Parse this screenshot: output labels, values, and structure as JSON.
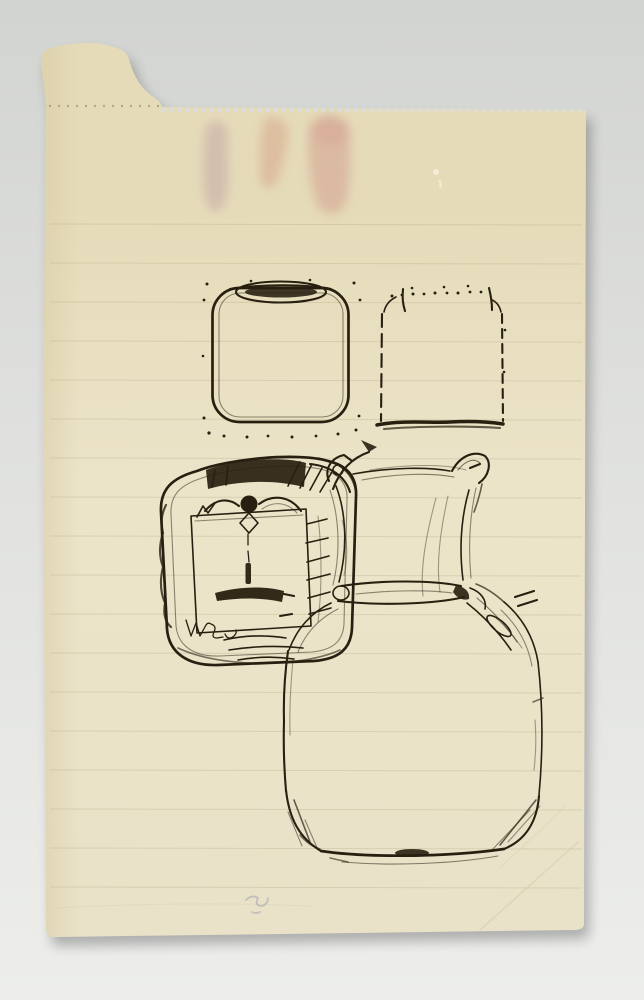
{
  "scene": {
    "description": "Photograph of a cream-coloured sheet of ruled notebook paper, torn from a perforated pad, lying on a grey surface. The sheet bears black-ink sketches of four container shapes and three faint pink watercolour stains near the top.",
    "background": {
      "top_color": "#d2d4d1",
      "bottom_color": "#edeeec"
    },
    "paper": {
      "light_color": "#ece4c9",
      "dark_color": "#e5dbb9",
      "edge_shade_color": "#d8cba4",
      "edge_features": [
        "torn-tab-top-left",
        "perforated-top-edge",
        "serrated-torn-top",
        "rounded-bottom-corners",
        "creases-bottom-right"
      ],
      "ruled_lines": {
        "color": "#b0a27c",
        "start_y": 224,
        "spacing": 39,
        "count": 18,
        "x1": 50,
        "x2": 582
      },
      "perforation": {
        "color": "#8d7c55",
        "y": 106,
        "x1": 50,
        "x2": 582,
        "spacing": 9
      }
    },
    "ink_color": "#281f10",
    "pencil_color": "#98a0ae",
    "crease_color": "#d5caac",
    "stains": [
      {
        "name": "mauve-stain",
        "color": "#bd97a0",
        "cx": 219,
        "cy": 168
      },
      {
        "name": "salmon-stain",
        "color": "#d6a286",
        "cx": 272,
        "cy": 150
      },
      {
        "name": "pink-stain",
        "color": "#d29a8c",
        "cx": 327,
        "cy": 165
      }
    ],
    "sketches": [
      {
        "name": "rounded-square-jar-with-lid",
        "description": "Rounded square container with an elliptical inked lid on top, dotted corners",
        "bounds": [
          210,
          280,
          360,
          438
        ]
      },
      {
        "name": "dotted-jar-silhouette",
        "description": "Jar outline drawn in dots and dashes with shoulders and a heavy solid base line",
        "bounds": [
          377,
          285,
          506,
          430
        ]
      },
      {
        "name": "dark-square-tin-with-face",
        "description": "Heavily worked square tin seen from above: dark inked top band, inner square, central knob with hanging drip, dark mouth-like bar, hatching and scribbles, illegible scribbled letters at lower left",
        "bounds": [
          158,
          450,
          372,
          668
        ]
      },
      {
        "name": "pinched-cushion-square",
        "description": "Square canvas/cushion shape with hooked, pinched corners and a rolled lower edge",
        "bounds": [
          326,
          450,
          538,
          650
        ]
      },
      {
        "name": "large-round-shouldered-jar",
        "description": "Large jar body with sloping shoulders, rounded hatched bottom corners and a heavy base line",
        "bounds": [
          278,
          596,
          546,
          872
        ]
      }
    ],
    "inscription": {
      "legible": false,
      "description": "small cursive scribble inside the dark tin, lower left"
    },
    "pencil_mark": {
      "description": "faint illegible pencil scribble near bottom centre-left",
      "x": 250,
      "y": 905
    }
  }
}
